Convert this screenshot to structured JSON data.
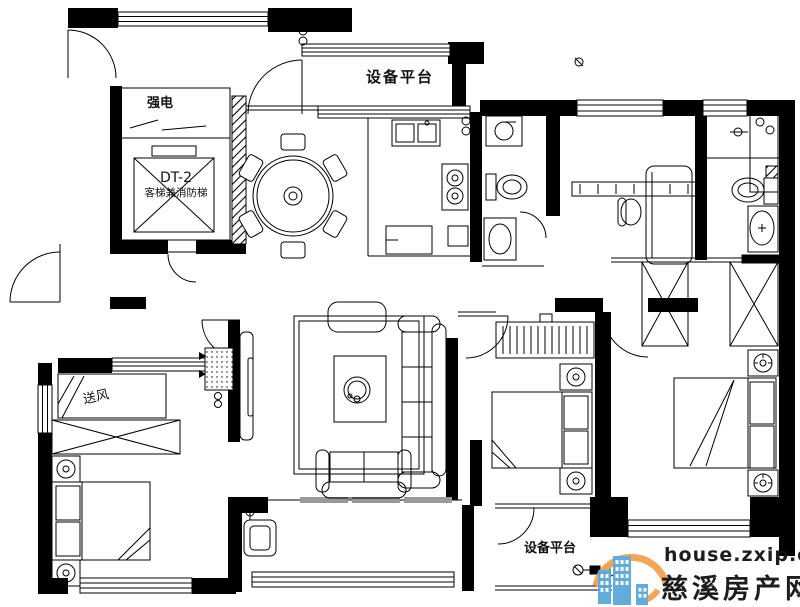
{
  "labels": {
    "strong_electric": "强电",
    "elevator_code": "DT-2",
    "elevator_name": "客梯兼消防梯",
    "equipment_platform_top": "设备平台",
    "air_supply": "送风",
    "equipment_platform_bottom": "设备平台"
  },
  "watermark": {
    "site_url": "house.zxip.com",
    "site_name": "慈溪房产网",
    "colors": {
      "swoosh": "#F5A14E",
      "buildings": "#58A9DB",
      "url_text": "#9E9E9E",
      "name_text": "#4BA3D9"
    }
  },
  "colors": {
    "background": "#FFFFFF",
    "line": "#000000"
  }
}
